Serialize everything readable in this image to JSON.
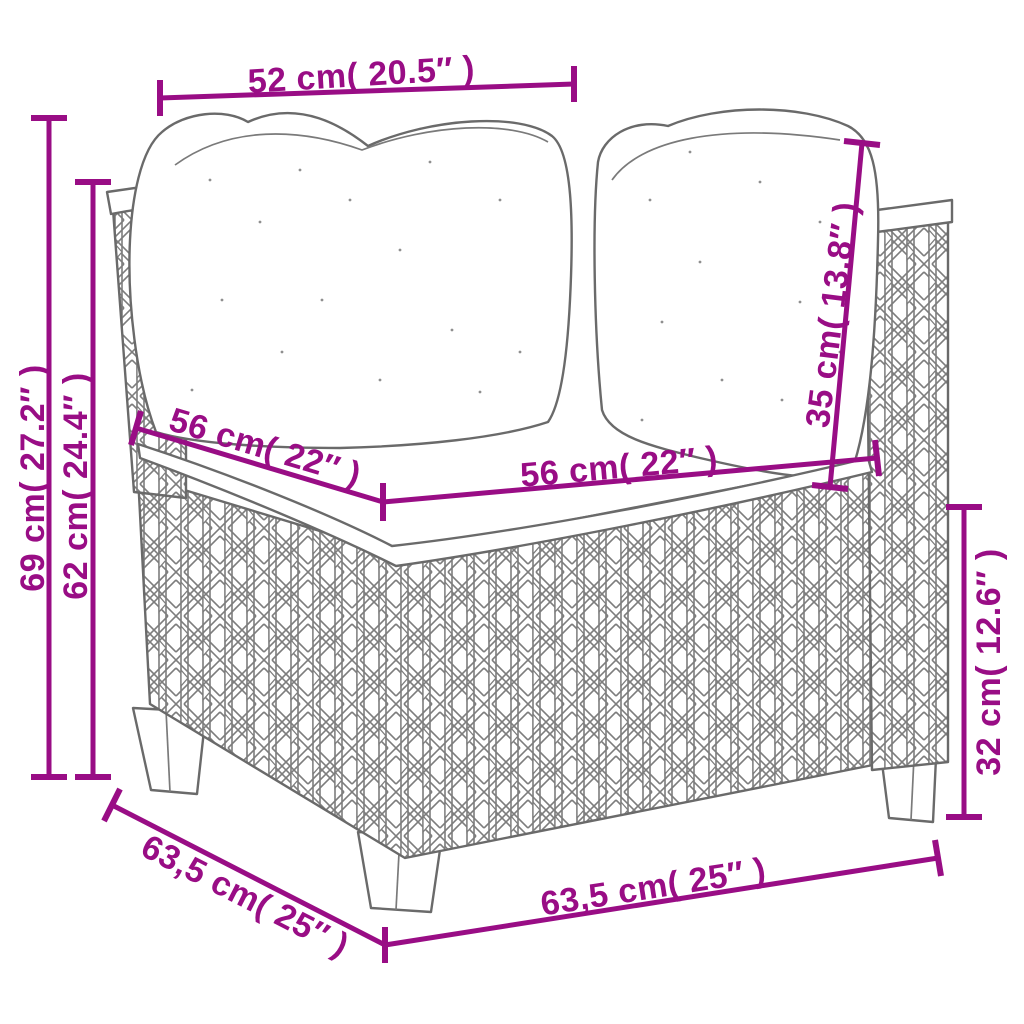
{
  "diagram": {
    "artwork": "corner-sofa-poly-rattan-line-drawing",
    "accent_color": "#990D85",
    "sketch_color": "#6a6a6a",
    "dimensions": {
      "top_width": "52 cm( 20.5″ )",
      "overall_height": "69 cm( 27.2″ )",
      "arm_height": "62 cm( 24.4″ )",
      "seat_depth": "56 cm( 22″ )",
      "seat_width": "56 cm( 22″ )",
      "back_cushion_height": "35 cm( 13.8″ )",
      "base_height": "32 cm( 12.6″ )",
      "base_depth": "63,5 cm( 25″ )",
      "base_width": "63,5 cm( 25″ )"
    }
  }
}
